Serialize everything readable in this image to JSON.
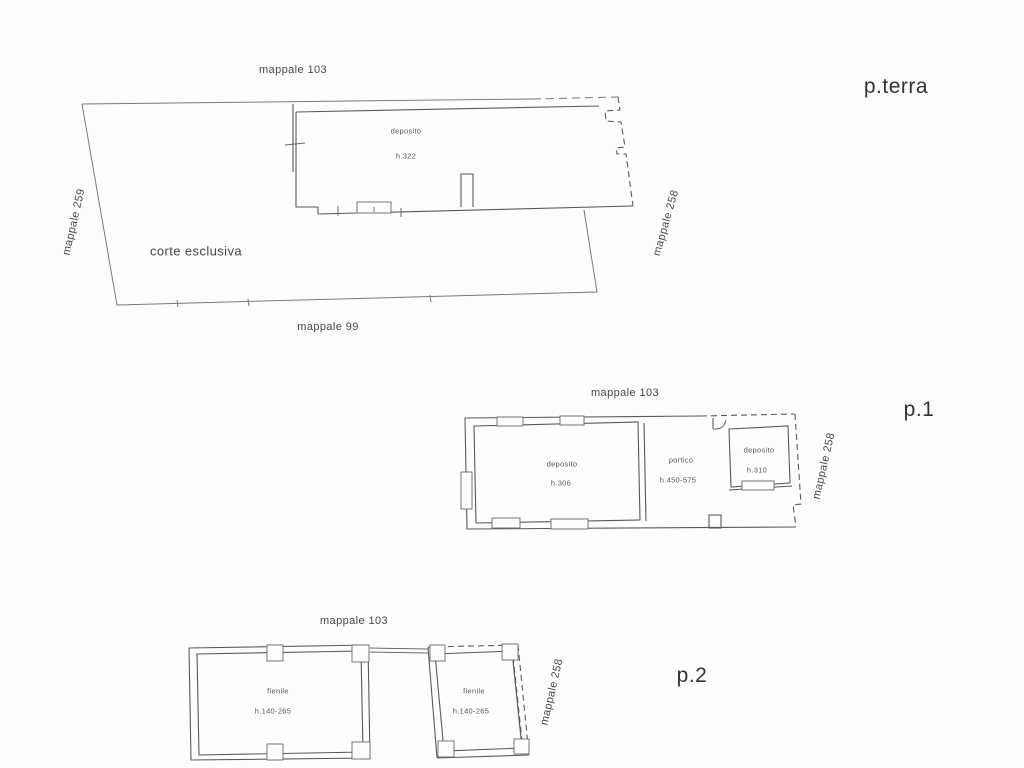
{
  "drawing_colors": {
    "background": "#fdfdfd",
    "line": "#5a5a5a",
    "parcel_line": "#787878",
    "text": "#3f3f3f"
  },
  "plans": {
    "pterra": {
      "floor_label": "p.terra",
      "mappale_top": "mappale 103",
      "mappale_left": "mappale 259",
      "mappale_right": "mappale 258",
      "mappale_bottom": "mappale 99",
      "courtyard_label": "corte esclusiva",
      "rooms": [
        {
          "name": "deposito",
          "height": "h.322"
        }
      ]
    },
    "p1": {
      "floor_label": "p.1",
      "mappale_top": "mappale 103",
      "mappale_right": "mappale 258",
      "rooms": [
        {
          "name": "deposito",
          "height": "h.306"
        },
        {
          "name": "portico",
          "height": "h.450-575"
        },
        {
          "name": "deposito",
          "height": "h.310"
        }
      ]
    },
    "p2": {
      "floor_label": "p.2",
      "mappale_top": "mappale 103",
      "mappale_right": "mappale 258",
      "rooms": [
        {
          "name": "fienile",
          "height": "h.140-265"
        },
        {
          "name": "fienile",
          "height": "h.140-265"
        }
      ]
    }
  }
}
